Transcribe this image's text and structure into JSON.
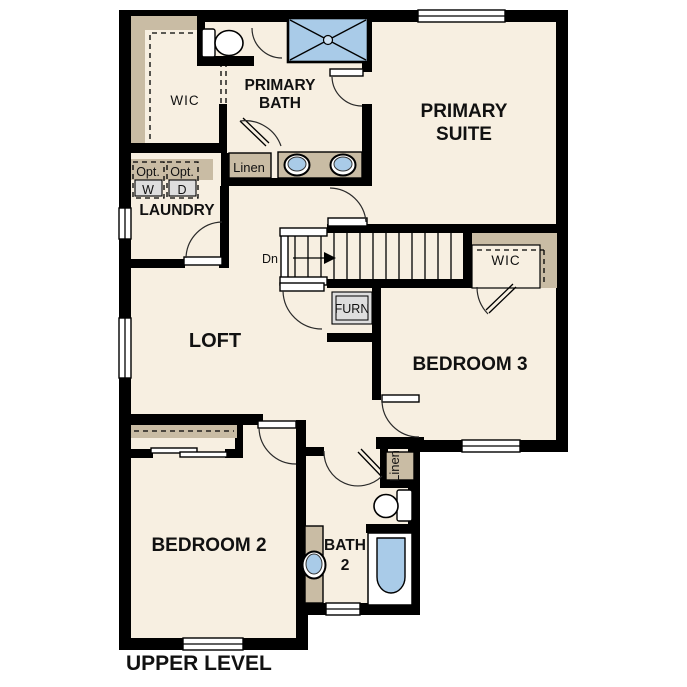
{
  "plan_title": "UPPER LEVEL",
  "colors": {
    "paper": "#ffffff",
    "floor": "#f7efe1",
    "wall": "#000000",
    "closet_tan": "#c9bca4",
    "fixture_blue": "#a9cbe8",
    "appliance_gray": "#dedede"
  },
  "rooms": {
    "wic_primary": "WIC",
    "primary_bath_line1": "PRIMARY",
    "primary_bath_line2": "BATH",
    "primary_suite_line1": "PRIMARY",
    "primary_suite_line2": "SUITE",
    "laundry": "LAUNDRY",
    "loft": "LOFT",
    "wic_bedroom3": "WIC",
    "bedroom3": "BEDROOM 3",
    "bedroom2": "BEDROOM 2",
    "bath2_line1": "BATH",
    "bath2_line2": "2"
  },
  "annotations": {
    "opt_washer_line1": "Opt.",
    "opt_washer_line2": "W",
    "opt_dryer_line1": "Opt.",
    "opt_dryer_line2": "D",
    "linen_primary": "Linen",
    "linen_hall": "Linen",
    "stairs_direction": "Dn",
    "furnace": "FURN"
  }
}
